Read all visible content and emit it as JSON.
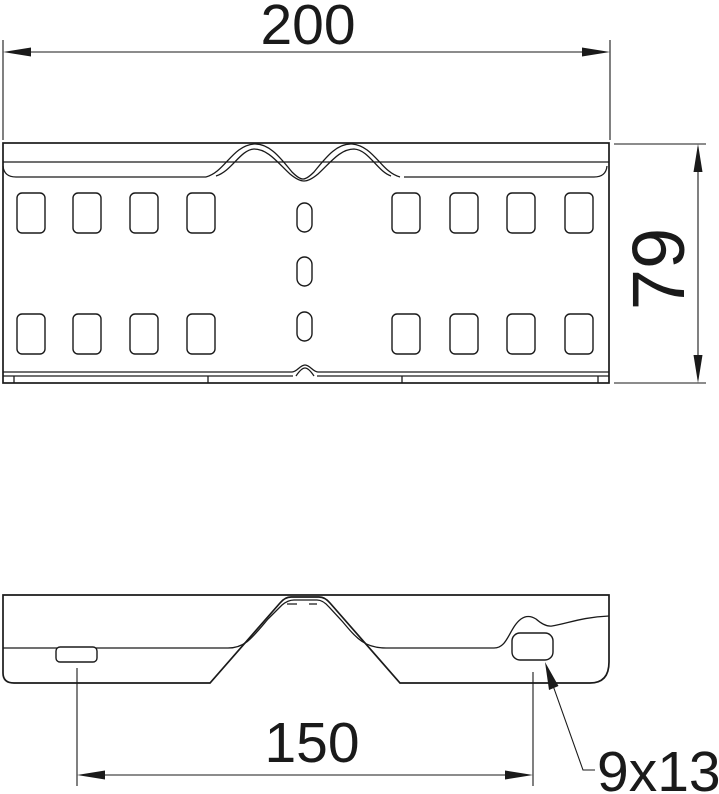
{
  "drawing": {
    "type": "technical-drawing",
    "views": {
      "front_view": "connector plate elevation with two rows of rectangular slots and center oval slots",
      "plan_view": "connector plate top view with trapezoid bend, small slot and oblong hole"
    },
    "colors": {
      "line": "#1a1a1a",
      "background": "#ffffff"
    }
  },
  "labels": {
    "overall_length": "200",
    "overall_height": "79",
    "hole_spacing": "150",
    "hole_size": "9x13"
  }
}
